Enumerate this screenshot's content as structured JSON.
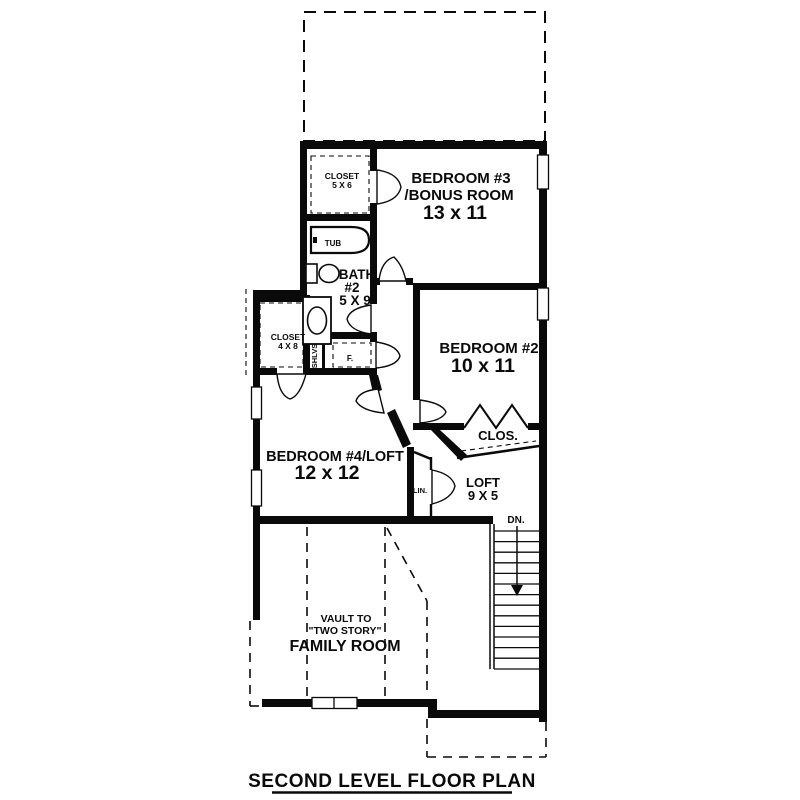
{
  "page": {
    "title": "SECOND LEVEL FLOOR PLAN"
  },
  "colors": {
    "wall": "#0a0a0a",
    "background": "#ffffff"
  },
  "rooms": {
    "bedroom3": {
      "name": "BEDROOM #3",
      "name2": "/BONUS ROOM",
      "dims": "13 x 11"
    },
    "bedroom2": {
      "name": "BEDROOM #2",
      "dims": "10 x 11"
    },
    "bedroom4": {
      "name": "BEDROOM #4/LOFT",
      "dims": "12 x 12"
    },
    "loft": {
      "name": "LOFT",
      "dims": "9 X 5"
    },
    "bath2": {
      "name": "BATH",
      "number": "#2",
      "dims": "5 X 9"
    },
    "closet_5x6": {
      "name": "CLOSET",
      "dims": "5 X 6"
    },
    "closet_4x8": {
      "name": "CLOSET",
      "dims": "4 X 8"
    },
    "family_room": {
      "vault_line1": "VAULT TO",
      "vault_line2": "\"TWO STORY\"",
      "name": "FAMILY ROOM"
    }
  },
  "labels": {
    "tub": "TUB",
    "shelves": "SHLVS",
    "furnace": "F.",
    "linen": "LIN.",
    "closet": "CLOS.",
    "down": "DN."
  }
}
